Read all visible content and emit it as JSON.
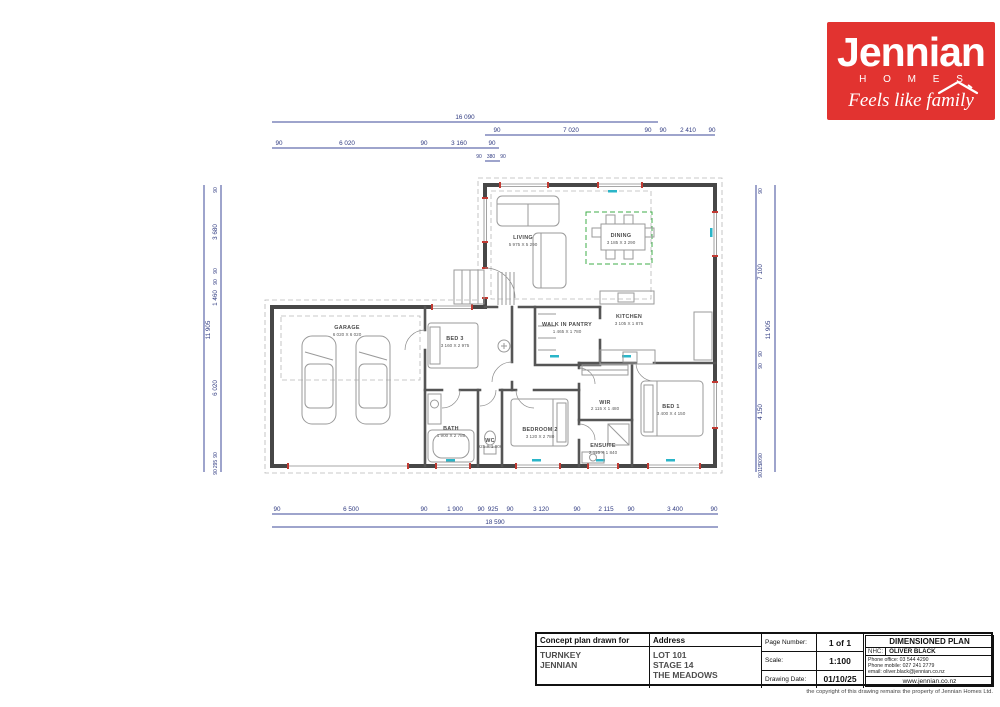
{
  "colors": {
    "brand_red": "#e23330",
    "dimension_blue": "#3d4a99",
    "wall_gray": "#474747",
    "accent_green": "#3fae49",
    "accent_cyan": "#2ab5c8",
    "marker_red": "#c23b33"
  },
  "logo": {
    "brand": "Jennian",
    "homes": "H O M E S",
    "tagline": "Feels like family"
  },
  "plan": {
    "rooms": [
      {
        "name": "LIVING",
        "size": "5 975 X 5 290"
      },
      {
        "name": "DINING",
        "size": "3 185 X 3 290"
      },
      {
        "name": "KITCHEN",
        "size": "3 105 X 1 875"
      },
      {
        "name": "WALK IN PANTRY",
        "size": "1 465 X 1 780"
      },
      {
        "name": "GARAGE",
        "size": "6 020 X 6 020"
      },
      {
        "name": "BED 3",
        "size": "3 160 X 2 975"
      },
      {
        "name": "BATH",
        "size": "1 900 X 2 780"
      },
      {
        "name": "WC",
        "size": "925 X 1 900"
      },
      {
        "name": "BEDROOM 2",
        "size": "3 120 X 2 780"
      },
      {
        "name": "WIR",
        "size": "2 115 X 1 480"
      },
      {
        "name": "ENSUITE",
        "size": "2 115 X 1 840"
      },
      {
        "name": "BED 1",
        "size": "3 400 X 4 150"
      }
    ],
    "dims": {
      "top_overall": "16 090",
      "top_row2": [
        "90",
        "7 020",
        "90",
        "90",
        "2 410",
        "90"
      ],
      "top_row3": [
        "90",
        "6 020",
        "90",
        "3 160",
        "90"
      ],
      "top_row4": [
        "90",
        "380",
        "90"
      ],
      "bottom": [
        "90",
        "6 500",
        "90",
        "1 900",
        "90",
        "925",
        "90",
        "3 120",
        "90",
        "2 115",
        "90",
        "3 400",
        "90"
      ],
      "bottom_overall": "18 590",
      "left": [
        "90",
        "3 680",
        "90",
        "90",
        "1 460",
        "6 020",
        "90",
        "295",
        "90"
      ],
      "left_overall": "11 905",
      "right": [
        "90",
        "7 100",
        "90",
        "90",
        "4 150",
        "90",
        "90",
        "115",
        "90"
      ],
      "right_overall": "11 905"
    }
  },
  "title_block": {
    "concept_label": "Concept plan drawn for",
    "client_line1": "TURNKEY",
    "client_line2": "JENNIAN",
    "address_label": "Address",
    "address1": "LOT 101",
    "address2": "STAGE 14",
    "address3": "THE MEADOWS",
    "page_label": "Page Number:",
    "page": "1 of 1",
    "scale_label": "Scale:",
    "scale": "1:100",
    "date_label": "Drawing Date:",
    "date": "01/10/25",
    "plan_type": "DIMENSIONED PLAN",
    "nhc_label": "NHC:",
    "nhc": "OLIVER BLACK",
    "phone_office": "Phone office: 03 544 4290",
    "phone_mobile": "Phone mobile: 027 241 2779",
    "email": "email: oliver.black@jennian.co.nz",
    "website": "www.jennian.co.nz",
    "copyright": "the copyright of this drawing remains the property of Jennian Homes Ltd."
  }
}
